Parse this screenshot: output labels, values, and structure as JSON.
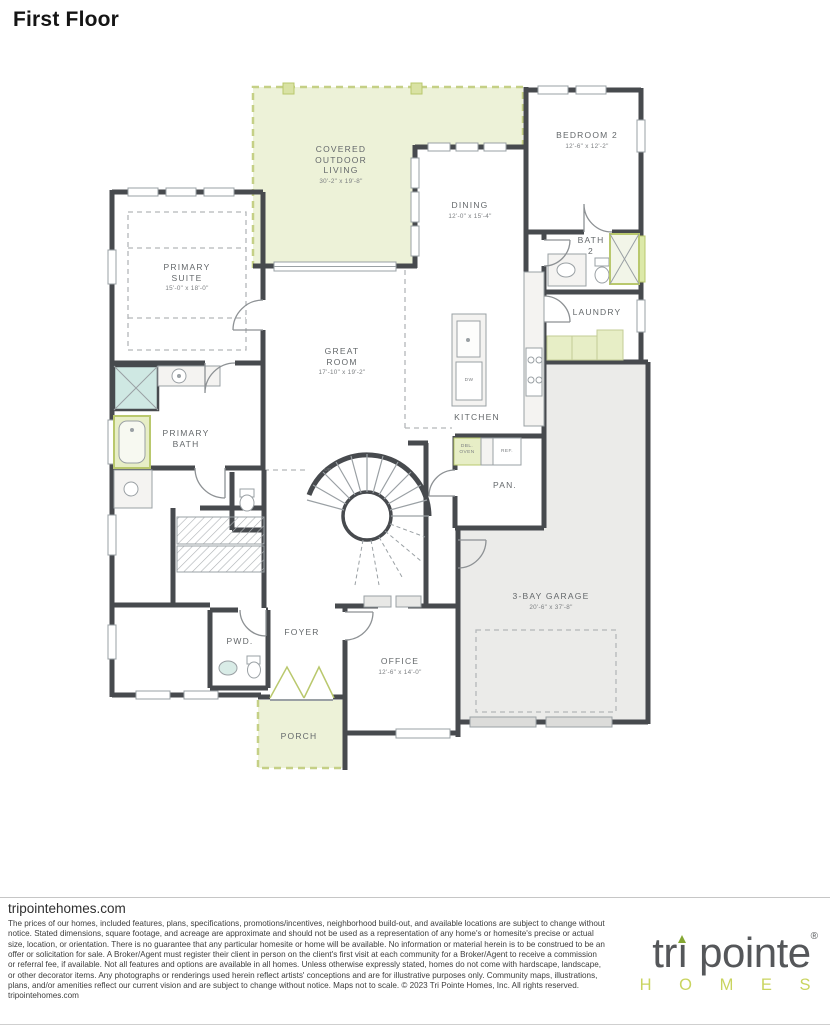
{
  "title": "First Floor",
  "floorplan": {
    "rooms": [
      {
        "name": "COVERED OUTDOOR LIVING",
        "dims": "30'-2\" x 19'-8\""
      },
      {
        "name": "BEDROOM 2",
        "dims": "12'-6\" x 12'-2\""
      },
      {
        "name": "DINING",
        "dims": "12'-0\" x 15'-4\""
      },
      {
        "name": "BATH 2",
        "dims": ""
      },
      {
        "name": "PRIMARY SUITE",
        "dims": "15'-0\" x 18'-0\""
      },
      {
        "name": "LAUNDRY",
        "dims": ""
      },
      {
        "name": "GREAT ROOM",
        "dims": "17'-10\" x 19'-2\""
      },
      {
        "name": "KITCHEN",
        "dims": ""
      },
      {
        "name": "PRIMARY BATH",
        "dims": ""
      },
      {
        "name": "3-BAY GARAGE",
        "dims": "20'-6\" x 37'-8\""
      },
      {
        "name": "PAN.",
        "dims": ""
      },
      {
        "name": "PWD.",
        "dims": ""
      },
      {
        "name": "FOYER",
        "dims": ""
      },
      {
        "name": "OFFICE",
        "dims": "12'-6\" x 14'-0\""
      },
      {
        "name": "PORCH",
        "dims": ""
      }
    ],
    "fixtures": {
      "dishwasher": "DW",
      "double_oven": "DBL. OVEN",
      "refrigerator": "REF.",
      "stairs_up": "UP"
    }
  },
  "footer": {
    "website": "tripointehomes.com",
    "disclaimer": "The prices of our homes, included features, plans, specifications, promotions/incentives, neighborhood build-out, and available locations are subject to change without notice. Stated dimensions, square footage, and acreage are approximate and should not be used as a representation of any home's or homesite's precise or actual size, location, or orientation. There is no guarantee that any particular homesite or home will be available. No information or material herein is to be construed to be an offer or solicitation for sale. A Broker/Agent must register their client in person on the client's first visit at each community for a Broker/Agent to receive a commission or referral fee, if available. Not all features and options are available in all homes. Unless otherwise expressly stated, homes do not come with hardscape, landscape, or other decorator items. Any photographs or renderings used herein reflect artists' conceptions and are for illustrative purposes only. Community maps, illustrations, plans, and/or amenities reflect our current vision and are subject to change without notice. Maps not to scale. © 2023 Tri Pointe Homes, Inc. All rights reserved. tripointehomes.com",
    "logo": {
      "part1": "tr",
      "part2": "ı",
      "part3": " pointe",
      "registered": "®",
      "homes": "H O M E S"
    }
  },
  "colors": {
    "wall": "#474a4e",
    "highlight_green_fill": "#edf2d8",
    "highlight_green_border": "#c5d086",
    "accent_green": "#b9c86d",
    "logo_green": "#85a733",
    "logo_homes_green": "#c9d45f",
    "garage_gray": "#ebebe9",
    "shower_blue": "#cfe8e3",
    "label_gray": "#64686b"
  }
}
